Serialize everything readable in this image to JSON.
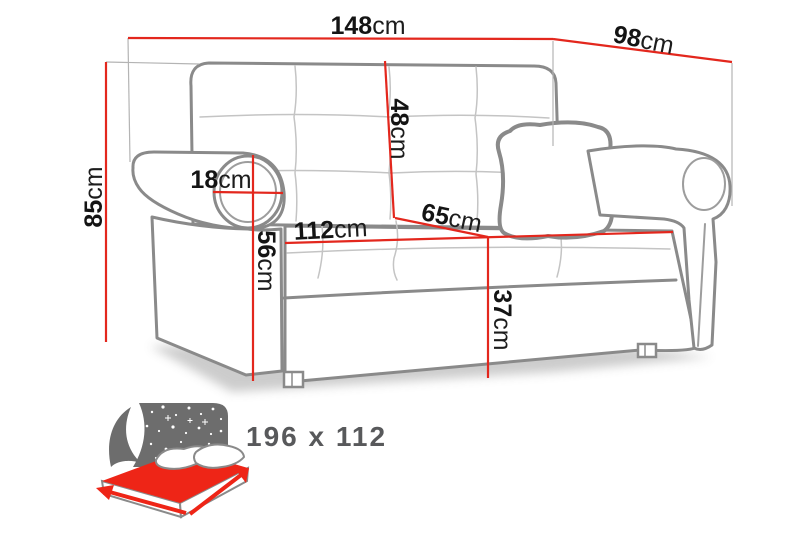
{
  "diagram": {
    "title": "sofa-dimensions-diagram",
    "dimensions": {
      "overall_width": {
        "value": "148",
        "unit": "cm"
      },
      "overall_depth": {
        "value": "98",
        "unit": "cm"
      },
      "overall_height": {
        "value": "85",
        "unit": "cm"
      },
      "armrest_width": {
        "value": "18",
        "unit": "cm"
      },
      "armrest_height": {
        "value": "56",
        "unit": "cm"
      },
      "seat_width": {
        "value": "112",
        "unit": "cm"
      },
      "seat_depth": {
        "value": "65",
        "unit": "cm"
      },
      "backrest_height": {
        "value": "48",
        "unit": "cm"
      },
      "seat_height": {
        "value": "37",
        "unit": "cm"
      }
    },
    "sleeping_area": {
      "label": "196 x 112"
    },
    "icons": {
      "sofa_bed_icon": "fold-out-bed with starry night backdrop, red mattress, two pillows, red size arrows"
    },
    "colors": {
      "dimension_red": "#e3271d",
      "mattress_red": "#ee2517",
      "sofa_outline_gray": "#8a8a8a",
      "icon_backdrop_gray": "#6d6d6d",
      "sleeping_label_gray": "#58595b",
      "background": "#ffffff"
    }
  }
}
